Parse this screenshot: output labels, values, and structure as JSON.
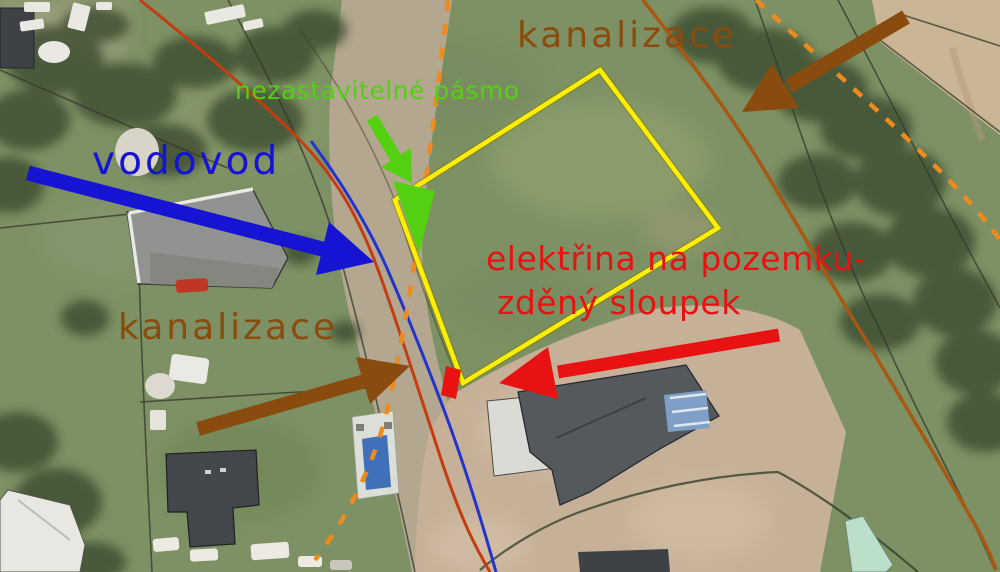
{
  "annotations": {
    "kanalizace_top": "kanalizace",
    "nezastavitelne_pasmo": "nezastavitelné pásmo",
    "vodovod": "vodovod",
    "kanalizace_left": "kanalizace",
    "elektrina_line1": "elektřina na pozemku-",
    "elektrina_line2": "zděný sloupek"
  },
  "colors": {
    "brown": "#8a4c0e",
    "green": "#53d012",
    "blue": "#1713d2",
    "red": "#e81212",
    "yellow": "#ffee00",
    "dashed_orange": "#ee8a1e",
    "solid_orange": "#a85812",
    "red_orange_line": "#c43c10",
    "water_blue": "#2334cc"
  }
}
